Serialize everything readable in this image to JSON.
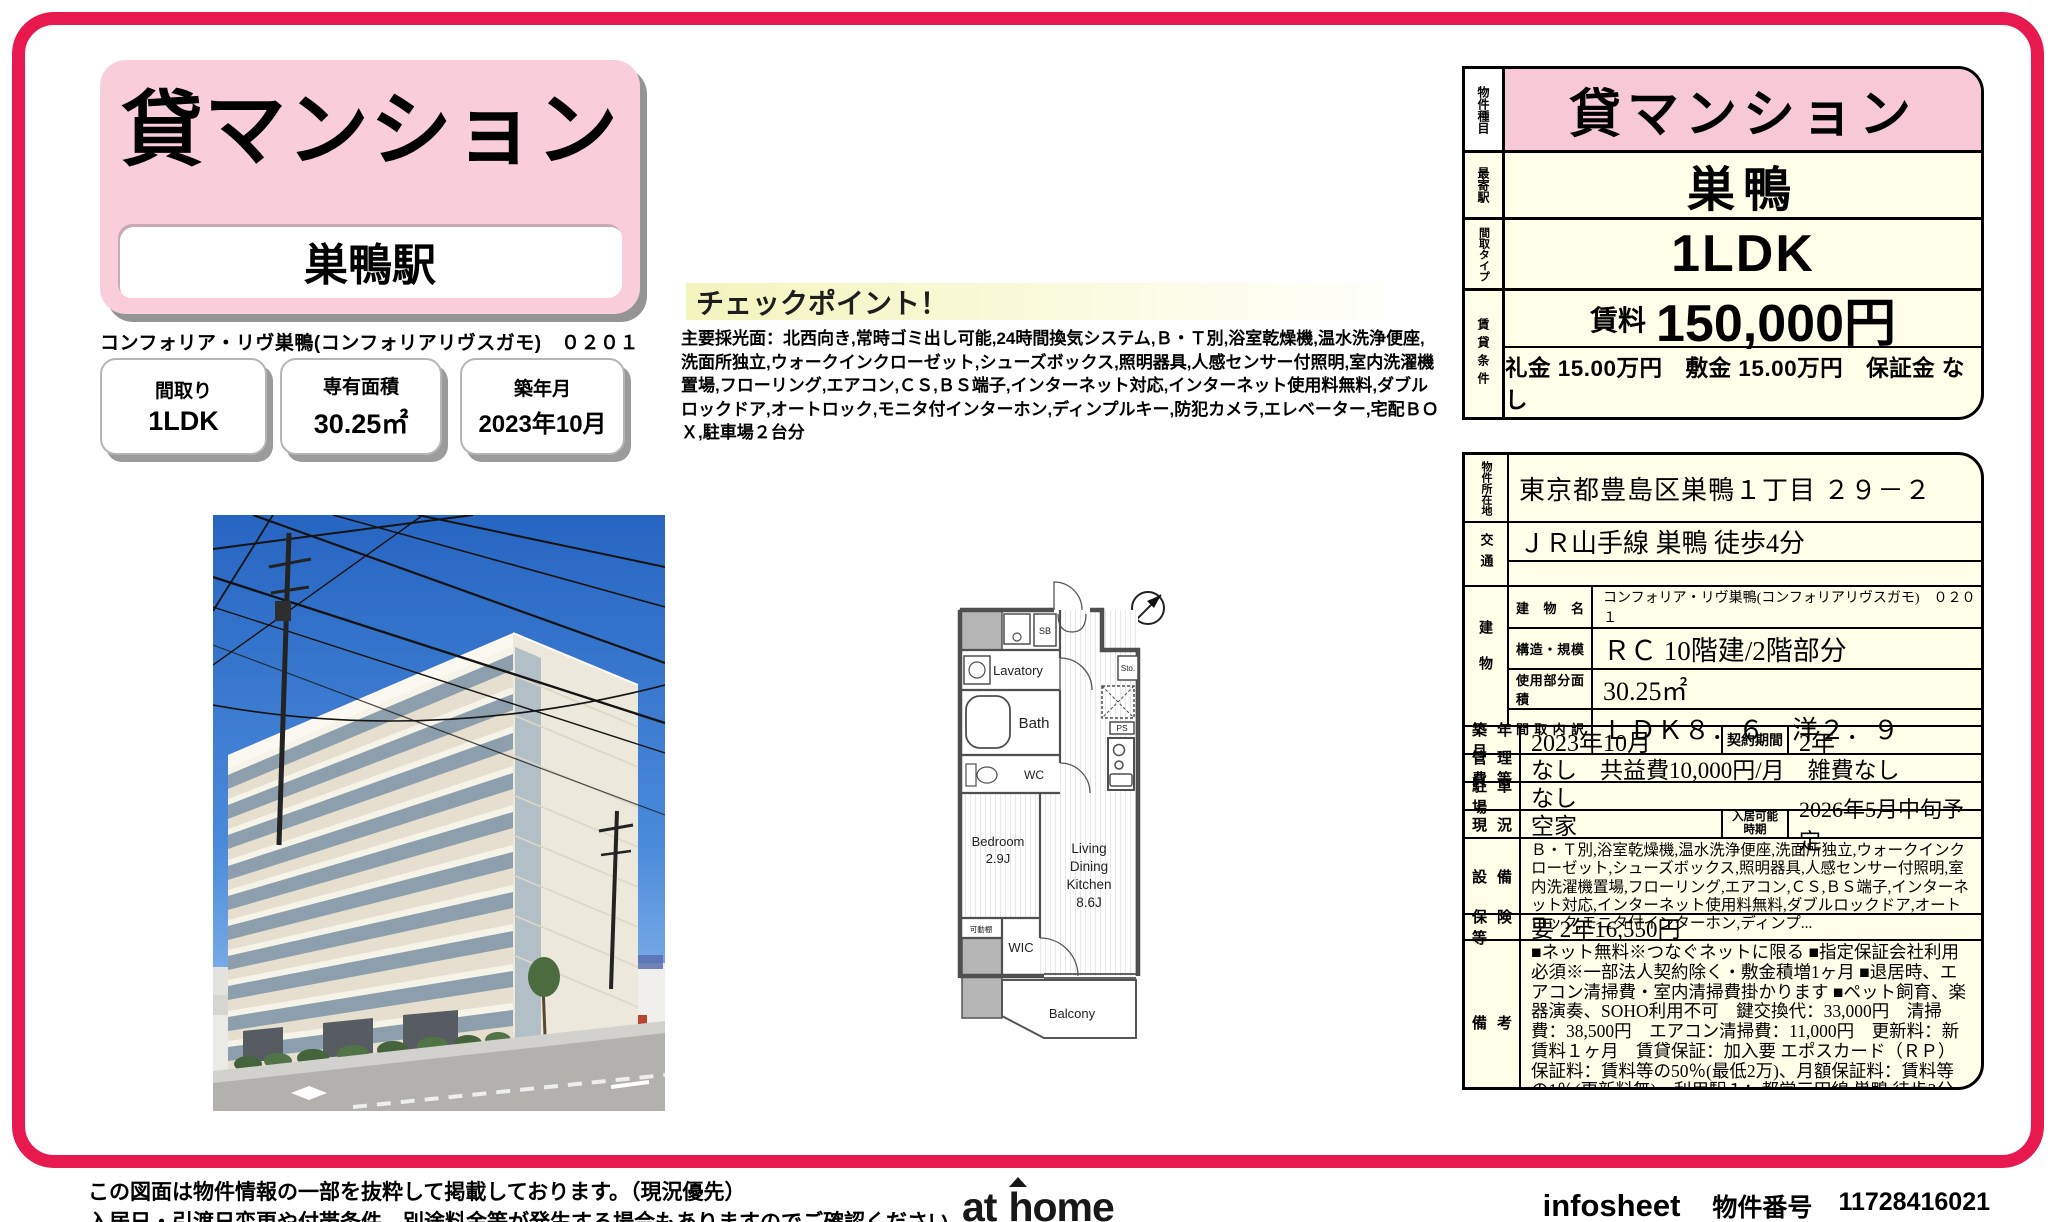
{
  "accent_color": "#e8194e",
  "left": {
    "type_title": "貸マンション",
    "station": "巣鴨駅",
    "building_line": "コンフォリア・リヴ巣鴨(コンフォリアリヴスガモ)　０２０１",
    "boxes": [
      {
        "label": "間取り",
        "value": "1LDK"
      },
      {
        "label": "専有面積",
        "value": "30.25㎡"
      },
      {
        "label": "築年月",
        "value": "2023年10月"
      }
    ]
  },
  "checkpoint": {
    "heading": "チェックポイント！",
    "body": "主要採光面：北西向き,常時ゴミ出し可能,24時間換気システム,Ｂ・Ｔ別,浴室乾燥機,温水洗浄便座,洗面所独立,ウォークインクローゼット,シューズボックス,照明器具,人感センサー付照明,室内洗濯機置場,フローリング,エアコン,ＣＳ,ＢＳ端子,インターネット対応,インターネット使用料無料,ダブルロックドア,オートロック,モニタ付インターホン,ディンプルキー,防犯カメラ,エレベーター,宅配ＢＯＸ,駐車場２台分"
  },
  "floorplan": {
    "compass": "N",
    "labels": {
      "sb": "SB",
      "lavatory": "Lavatory",
      "bath": "Bath",
      "wc": "WC",
      "sto": "Sto.",
      "ps": "PS",
      "bedroom1": "Bedroom",
      "bedroom2": "2.9J",
      "ldk1": "Living",
      "ldk2": "Dining",
      "ldk3": "Kitchen",
      "ldk4": "8.6J",
      "wic": "WIC",
      "shelf": "可動棚",
      "balcony": "Balcony"
    }
  },
  "summary_table": {
    "type_label": "物件種目",
    "type_value": "貸マンション",
    "station_label": "最寄駅",
    "station_value": "巣鴨",
    "layout_label": "間取タイプ",
    "layout_value": "1LDK",
    "terms_label": "賃貸条件",
    "rent_label": "賃料",
    "rent_value": "150,000円",
    "fees": "礼金 15.00万円　敷金 15.00万円　保証金 なし"
  },
  "detail_table": {
    "address_label": "物件所在地",
    "address": "東京都豊島区巣鴨１丁目 ２９－２",
    "access_label": "交通",
    "access": "ＪＲ山手線 巣鴨 徒歩4分",
    "access2": "",
    "building_label": "建物",
    "bname_label": "建物名",
    "bname": "コンフォリア・リヴ巣鴨(コンフォリアリヴスガモ)　０２０１",
    "structure_label": "構造・規模",
    "structure": "ＲＣ 10階建/2階部分",
    "area_label": "使用部分面積",
    "area": "30.25㎡",
    "layout_detail_label": "間取内訳",
    "layout_detail": "ＬＤＫ８．６　洋２．９",
    "built_label": "築年月",
    "built": "2023年10月",
    "contract_label": "契約期間",
    "contract": "2年",
    "fees_label": "管理費等",
    "fees": "なし　共益費10,000円/月　雑費なし",
    "parking_label": "駐車場",
    "parking": "なし",
    "status_label": "現況",
    "status": "空家",
    "movein_label": "入居可能時期",
    "movein": "2026年5月中旬予定",
    "equipment_label": "設備",
    "equipment": "Ｂ・Ｔ別,浴室乾燥機,温水洗浄便座,洗面所独立,ウォークインクローゼット,シューズボックス,照明器具,人感センサー付照明,室内洗濯機置場,フローリング,エアコン,ＣＳ,ＢＳ端子,インターネット対応,インターネット使用料無料,ダブルロックドア,オートロック,モニタ付インターホン,ディンプ...",
    "insurance_label": "保険等",
    "insurance": "要 2年16,550円",
    "notes_label": "備考",
    "notes": "■ネット無料※つなぐネットに限る ■指定保証会社利用必須※一部法人契約除く・敷金積増1ヶ月 ■退居時、エアコン清掃費・室内清掃費掛かります ■ペット飼育、楽器演奏、SOHO利用不可　鍵交換代：33,000円　清掃費：38,500円　エアコン清掃費：11,000円　更新料：新賃料１ヶ月　賃貸保証：加入要 エポスカード（ＲＰ）　保証料：賃料等の50％(最低2万)、月額保証料：賃料等の1％(更新料無)　利用駅１：都営三田線 巣鴨 徒歩3分"
  },
  "footer": {
    "disclaimer1": "この図面は物件情報の一部を抜粋して掲載しております。（現況優先）",
    "disclaimer2": "入居日・引渡日変更や付帯条件、別途料金等が発生する場合もありますのでご確認ください。",
    "logo_at": "at",
    "logo_h": "h",
    "logo_ome": "ome",
    "sheet_name": "infosheet",
    "property_no_label": "物件番号",
    "property_no": "11728416021"
  }
}
